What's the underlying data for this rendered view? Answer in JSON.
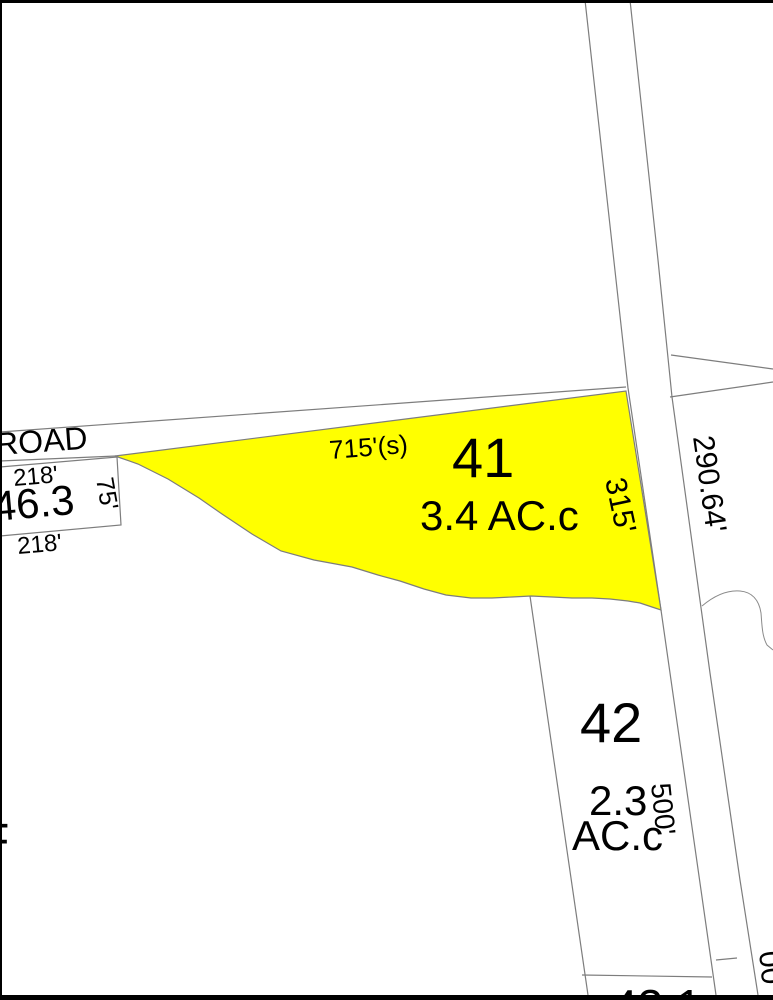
{
  "colors": {
    "highlight_fill": "#ffff00",
    "boundary_line": "#7d7d7d",
    "border": "#000000",
    "text": "#000000"
  },
  "road": {
    "label": "ROAD"
  },
  "parcels": {
    "p41": {
      "number": "41",
      "area": "3.4 AC.c",
      "front_dim": "715'(s)",
      "side_dim": "315'"
    },
    "p42": {
      "number": "42",
      "area_value": "2.3",
      "area_unit": "AC.c",
      "side_dim": "500'"
    },
    "p46_3": {
      "number": "46.3",
      "dim_top": "218'",
      "dim_side": "75'",
      "dim_bottom": "218'"
    },
    "p_east": {
      "road_dim": "290.64'"
    },
    "p_bottom": {
      "number_partial": "43.1"
    },
    "p_right": {
      "dim_partial": "00"
    },
    "edge_letter": "F"
  }
}
